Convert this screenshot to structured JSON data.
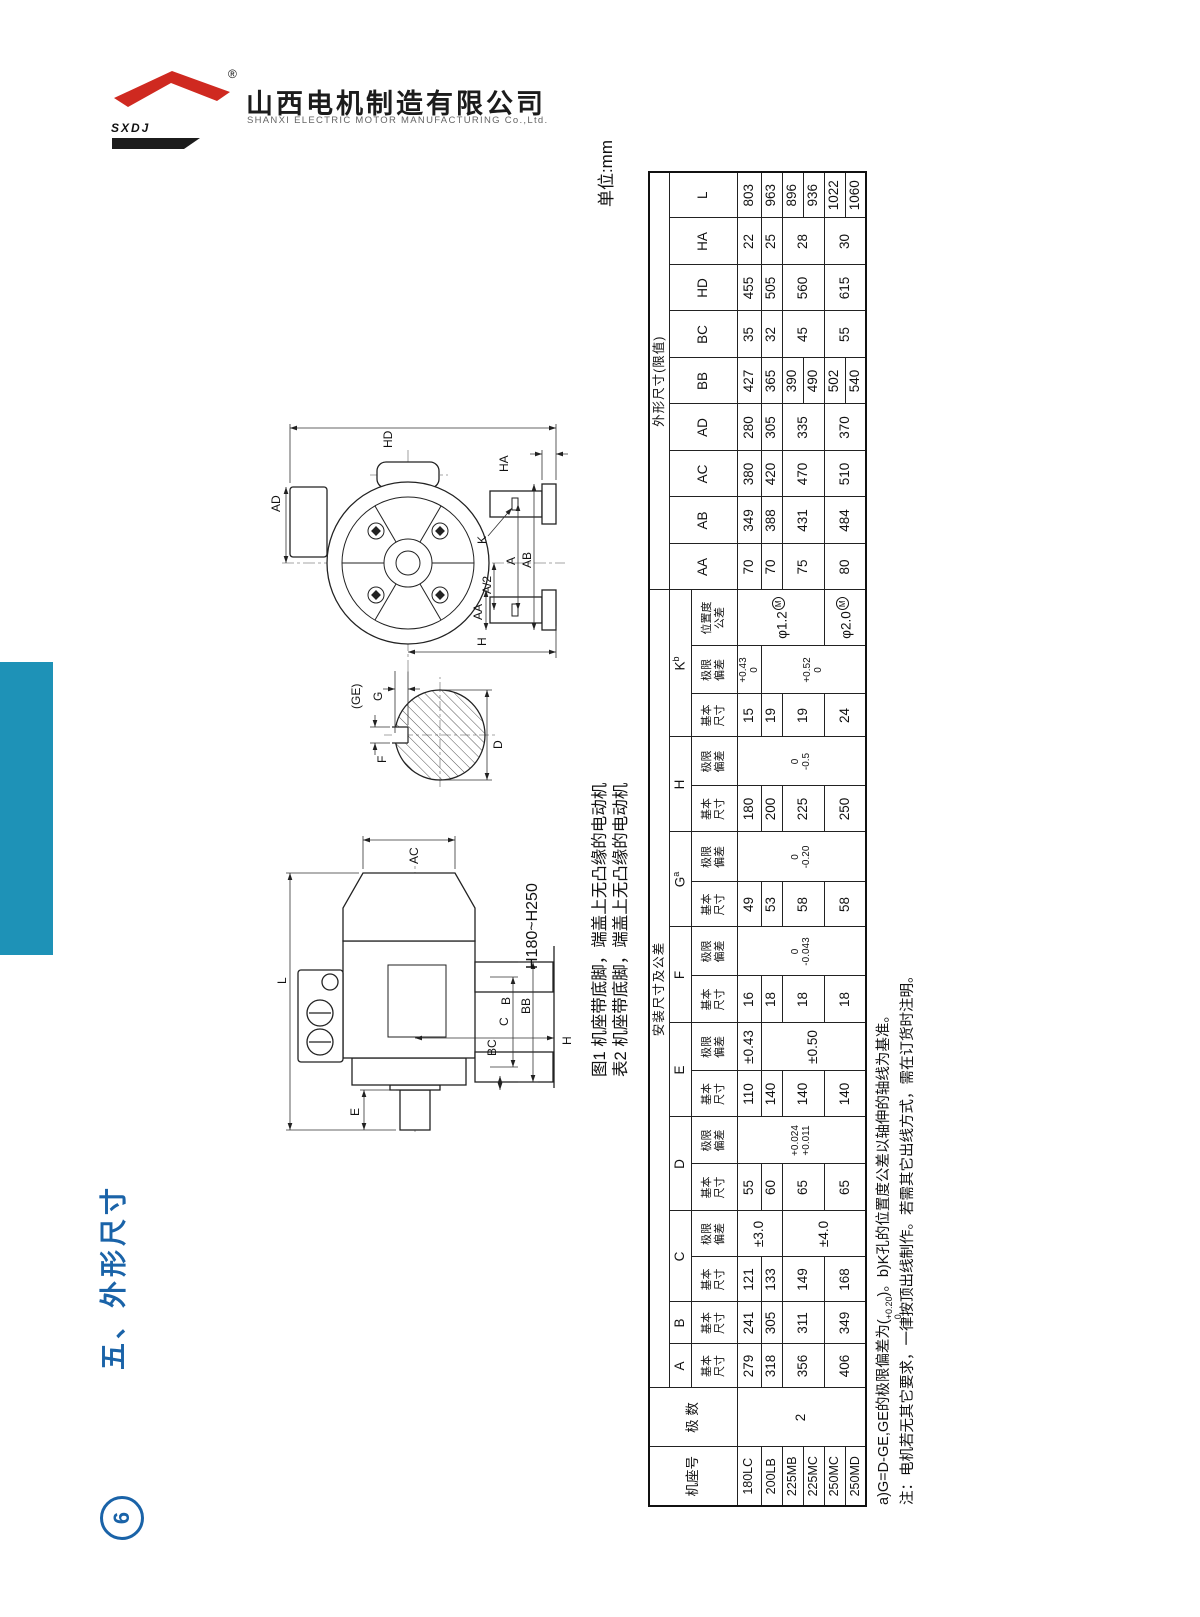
{
  "header": {
    "logo_text": "SXDJ",
    "registered_mark": "®",
    "company_cn": "山西电机制造有限公司",
    "company_en": "SHANXI ELECTRIC MOTOR MANUFACTURING Co.,Ltd."
  },
  "sidebar": {
    "section_title": "五、外形尺寸",
    "page_number": "6"
  },
  "content": {
    "unit_label": "单位:mm",
    "fig_caption": "图1 机座带底脚，端盖上无凸缘的电动机",
    "table_caption": "表2 机座带底脚，端盖上无凸缘的电动机",
    "frame_range_label": "H180~H250"
  },
  "colors": {
    "accent_blue": "#1a63a8",
    "sidebar_teal": "#1e92b7",
    "logo_red": "#cf2920",
    "ink": "#1a1a1a"
  },
  "drawing_labels": {
    "side": {
      "L": "L",
      "AC": "AC",
      "E": "E",
      "H": "H",
      "B": "B",
      "BB": "BB",
      "C": "C",
      "BC": "BC"
    },
    "section": {
      "F": "F",
      "GE": "(GE)",
      "G": "G",
      "D": "D"
    },
    "front": {
      "HD": "HD",
      "AD": "AD",
      "HA": "HA",
      "H": "H",
      "K": "K",
      "A": "A",
      "A2": "A/2",
      "AA": "AA",
      "AB": "AB"
    }
  },
  "table": {
    "group_install": "安装尺寸及公差",
    "group_outline": "外形尺寸(限值)",
    "frame_col": "机座号",
    "poles_col": "极 数",
    "sub_basic": "基本尺寸",
    "sub_dev": "极限偏差",
    "sub_pos": "位置度公差",
    "col_names": {
      "A": "A",
      "B": "B",
      "C": "C",
      "D": "D",
      "E": "E",
      "F": "F",
      "G": "G",
      "H": "H",
      "K": "K",
      "AA": "AA",
      "AB": "AB",
      "AC": "AC",
      "AD": "AD",
      "BB": "BB",
      "BC": "BC",
      "HD": "HD",
      "HA": "HA",
      "L": "L"
    },
    "sup_g": "a",
    "sup_k": "b",
    "pos_mark": "M",
    "frames": [
      "180LC",
      "200LB",
      "225MB",
      "225MC",
      "250MC",
      "250MD"
    ],
    "poles": "2",
    "A": [
      "279",
      "318",
      "356",
      "406"
    ],
    "B": [
      "241",
      "305",
      "311",
      "349"
    ],
    "C_basic": [
      "121",
      "133",
      "149",
      "168"
    ],
    "C_dev": [
      "±3.0",
      "±4.0"
    ],
    "D_basic": [
      "55",
      "60",
      "65",
      "65"
    ],
    "D_dev": [
      "+0.024",
      "+0.011"
    ],
    "E_basic": [
      "110",
      "140",
      "140",
      "140"
    ],
    "E_dev": [
      "±0.43",
      "±0.50"
    ],
    "F_basic": [
      "16",
      "18",
      "18",
      "18"
    ],
    "F_dev": [
      "0",
      "-0.043"
    ],
    "G_basic": [
      "49",
      "53",
      "58",
      "58"
    ],
    "G_dev": [
      "0",
      "-0.20"
    ],
    "H_basic": [
      "180",
      "200",
      "225",
      "250"
    ],
    "H_dev": [
      "0",
      "-0.5"
    ],
    "K_basic": [
      "15",
      "19",
      "19",
      "24"
    ],
    "K_dev1": [
      "+0.43",
      "0"
    ],
    "K_dev2": [
      "+0.52",
      "0"
    ],
    "K_pos": [
      "φ1.2",
      "φ2.0"
    ],
    "AA": [
      "70",
      "70",
      "75",
      "80"
    ],
    "AB": [
      "349",
      "388",
      "431",
      "484"
    ],
    "AC": [
      "380",
      "420",
      "470",
      "510"
    ],
    "AD": [
      "280",
      "305",
      "335",
      "370"
    ],
    "BB": [
      "427",
      "365",
      "390",
      "490",
      "502",
      "540"
    ],
    "BC": [
      "35",
      "32",
      "45",
      "55"
    ],
    "HD": [
      "455",
      "505",
      "560",
      "615"
    ],
    "HA": [
      "22",
      "25",
      "28",
      "30"
    ],
    "L": [
      "803",
      "963",
      "896",
      "936",
      "1022",
      "1060"
    ]
  },
  "notes": {
    "a_prefix": "a)G=D-GE,GE的极限偏差为(",
    "a_tol_top": "+0.20",
    "a_tol_bot": "0",
    "a_suffix": ")。b)K孔的位置度公差以轴伸的轴线为基准。",
    "line2": "注：电机若无其它要求，一律按顶出线制作。若需其它出线方式，需在订货时注明。"
  }
}
